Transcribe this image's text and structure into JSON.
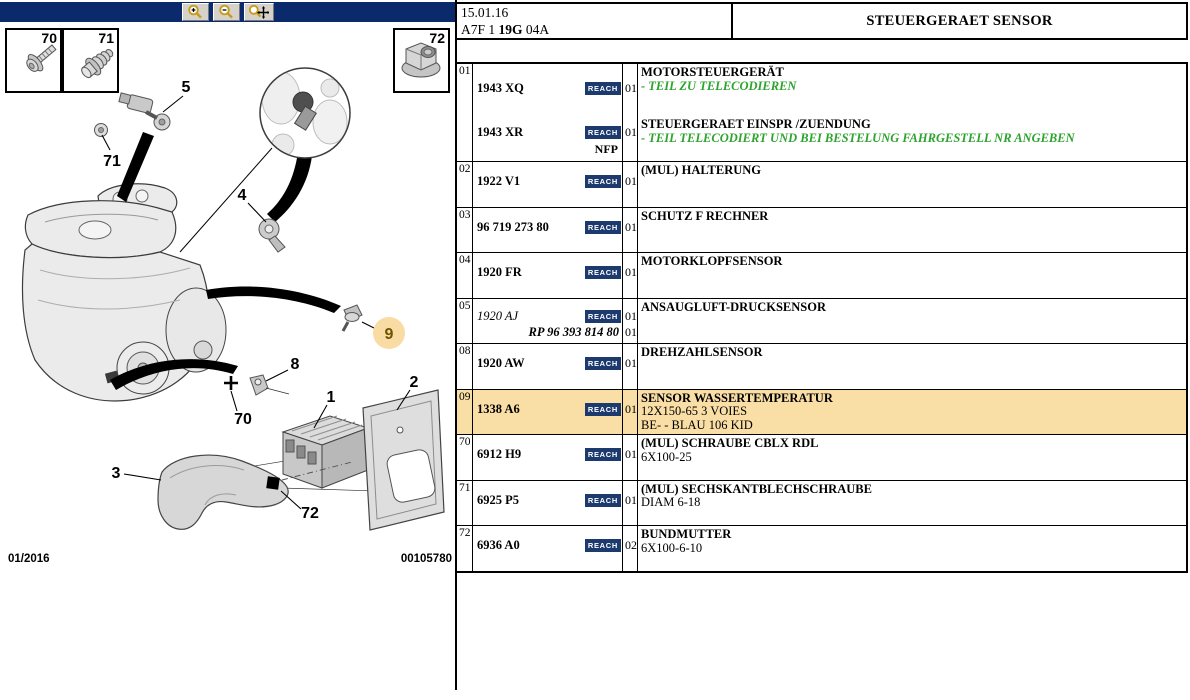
{
  "colors": {
    "toolbar_navy": "#0A2A6B",
    "reach_badge_navy": "#1C3A6E",
    "highlight_orange": "#F9DEA5",
    "callout_circle_orange": "#F8DCA4",
    "note_green": "#2EA32E"
  },
  "toolbar": {
    "icons": [
      "zoom-in-icon",
      "zoom-out-icon",
      "zoom-pan-icon"
    ]
  },
  "header": {
    "date": "15.01.16",
    "code_pre": "A7F 1 ",
    "code_bold": "19G",
    "code_post": " 04A",
    "title": "STEUERGERAET SENSOR"
  },
  "diagram": {
    "insets": {
      "i70": "70",
      "i71": "71",
      "i72": "72"
    },
    "callouts": {
      "c5": "5",
      "c71": "71",
      "c4": "4",
      "c9": "9",
      "c8": "8",
      "c70": "70",
      "c1": "1",
      "c2": "2",
      "c3": "3",
      "c72": "72"
    },
    "highlighted_callout": "9",
    "footer_left": "01/2016",
    "footer_right": "00105780"
  },
  "parts_table": {
    "reach_label": "REACH",
    "rows": [
      {
        "ref": "01",
        "tall": true,
        "highlight": false,
        "entries": [
          {
            "number": "1943 XQ",
            "number_style": "bold",
            "reach": true,
            "qty": "01",
            "desc": [
              {
                "text": "MOTORSTEUERGERÄT",
                "style": "bold"
              },
              {
                "text": "- TEIL ZU TELECODIEREN",
                "style": "green"
              }
            ]
          },
          {
            "number": "1943 XR",
            "number_style": "bold",
            "reach": true,
            "qty": "01",
            "note": "NFP",
            "desc": [
              {
                "text": "STEUERGERAET EINSPR /ZUENDUNG",
                "style": "bold"
              },
              {
                "text": "- TEIL TELECODIERT UND BEI BESTELUNG FAHRGESTELL NR ANGEBEN",
                "style": "green"
              }
            ]
          }
        ]
      },
      {
        "ref": "02",
        "entries": [
          {
            "number": "1922 V1",
            "number_style": "bold",
            "reach": true,
            "qty": "01",
            "desc": [
              {
                "text": "(MUL) HALTERUNG",
                "style": "bold"
              }
            ]
          }
        ]
      },
      {
        "ref": "03",
        "entries": [
          {
            "number": "96 719 273 80",
            "number_style": "bold",
            "reach": true,
            "qty": "01",
            "desc": [
              {
                "text": "SCHUTZ F RECHNER",
                "style": "bold"
              }
            ]
          }
        ]
      },
      {
        "ref": "04",
        "entries": [
          {
            "number": "1920 FR",
            "number_style": "bold",
            "reach": true,
            "qty": "01",
            "desc": [
              {
                "text": "MOTORKLOPFSENSOR",
                "style": "bold"
              }
            ]
          }
        ]
      },
      {
        "ref": "05",
        "entries": [
          {
            "number": "1920 AJ",
            "number_style": "italic",
            "reach": true,
            "qty": "01",
            "desc": [
              {
                "text": "ANSAUGLUFT-DRUCKSENSOR",
                "style": "bold"
              }
            ]
          },
          {
            "number": "RP 96 393 814 80",
            "number_style": "bolditalic",
            "align": "right",
            "reach": false,
            "qty": "01",
            "desc": []
          }
        ]
      },
      {
        "ref": "08",
        "entries": [
          {
            "number": "1920 AW",
            "number_style": "bold",
            "reach": true,
            "qty": "01",
            "desc": [
              {
                "text": "DREHZAHLSENSOR",
                "style": "bold"
              }
            ]
          }
        ]
      },
      {
        "ref": "09",
        "highlight": true,
        "entries": [
          {
            "number": "1338 A6",
            "number_style": "bold",
            "reach": true,
            "qty": "01",
            "desc": [
              {
                "text": "SENSOR WASSERTEMPERATUR",
                "style": "bold"
              },
              {
                "text": "12X150-65 3 VOIES",
                "style": "normal"
              },
              {
                "text": "BE- - BLAU 106 KID",
                "style": "normal"
              }
            ]
          }
        ]
      },
      {
        "ref": "70",
        "entries": [
          {
            "number": "6912 H9",
            "number_style": "bold",
            "reach": true,
            "qty": "01",
            "desc": [
              {
                "text": "(MUL) SCHRAUBE CBLX RDL",
                "style": "bold"
              },
              {
                "text": "6X100-25",
                "style": "normal"
              }
            ]
          }
        ]
      },
      {
        "ref": "71",
        "entries": [
          {
            "number": "6925 P5",
            "number_style": "bold",
            "reach": true,
            "qty": "01",
            "desc": [
              {
                "text": "(MUL) SECHSKANTBLECHSCHRAUBE",
                "style": "bold"
              },
              {
                "text": "DIAM 6-18",
                "style": "normal"
              }
            ]
          }
        ]
      },
      {
        "ref": "72",
        "entries": [
          {
            "number": "6936 A0",
            "number_style": "bold",
            "reach": true,
            "qty": "02",
            "desc": [
              {
                "text": "BUNDMUTTER",
                "style": "bold"
              },
              {
                "text": "6X100-6-10",
                "style": "normal"
              }
            ]
          }
        ]
      }
    ]
  }
}
